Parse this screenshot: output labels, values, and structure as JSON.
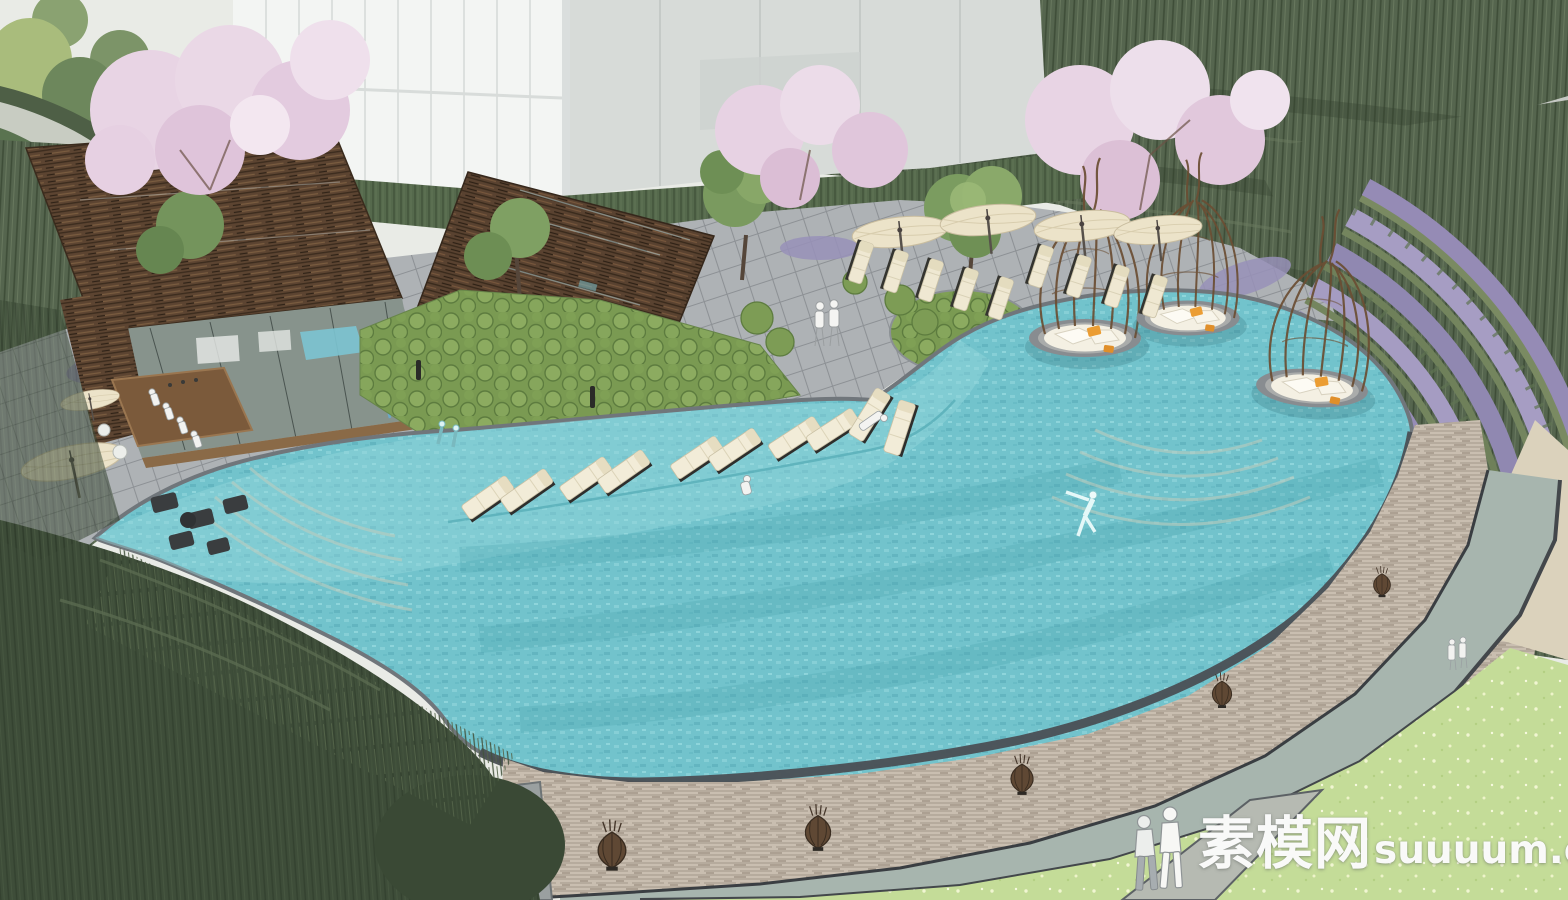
{
  "meta": {
    "title": "Resort pool landscape rendering",
    "render_style": "sketchup-aerial-perspective",
    "image_type": "architectural-visualization"
  },
  "watermark": {
    "site_name": "素模网",
    "site_domain": "suuuum.com",
    "full_text": "素模网suuuum.com"
  },
  "scene": {
    "areas": [
      "white building massing",
      "bamboo hillside",
      "cherry blossom trees",
      "timber slat pavilion with pool bar",
      "timber trellis pavilion with indoor pool",
      "paved pool deck",
      "freeform infinity pool with underwater steps",
      "in-pool lounger shelf",
      "birdcage cabana islands",
      "lavender terraces",
      "stacked stone retaining wall",
      "lower walkway with wicker lanterns",
      "flowered lawn with footpath",
      "bamboo and willow foreground"
    ],
    "counts": {
      "cabana_pods": 3,
      "in_pool_loungers": 10,
      "deck_loungers": 9,
      "deck_umbrellas": 4,
      "cafe_umbrellas": 2,
      "wicker_lanterns": 5,
      "lavender_terrace_rows": 5,
      "people": 15
    }
  },
  "palette": {
    "pool_water": "#72c3cc",
    "pool_shallow": "#98d9de",
    "deck_paving": "#aeb2b5",
    "timber": "#5c4431",
    "foliage_dark": "#4a5a45",
    "shrub_green": "#7fa05a",
    "blossom_pink": "#e8d4e4",
    "lavender": "#968cb6",
    "lawn": "#c4dc98",
    "stone_wall": "#c9beb0",
    "umbrella_cream": "#ece3c9",
    "cushion_cream": "#efe8d2",
    "pillow_orange": "#eb9d33",
    "building_white": "#f3f5f3"
  }
}
